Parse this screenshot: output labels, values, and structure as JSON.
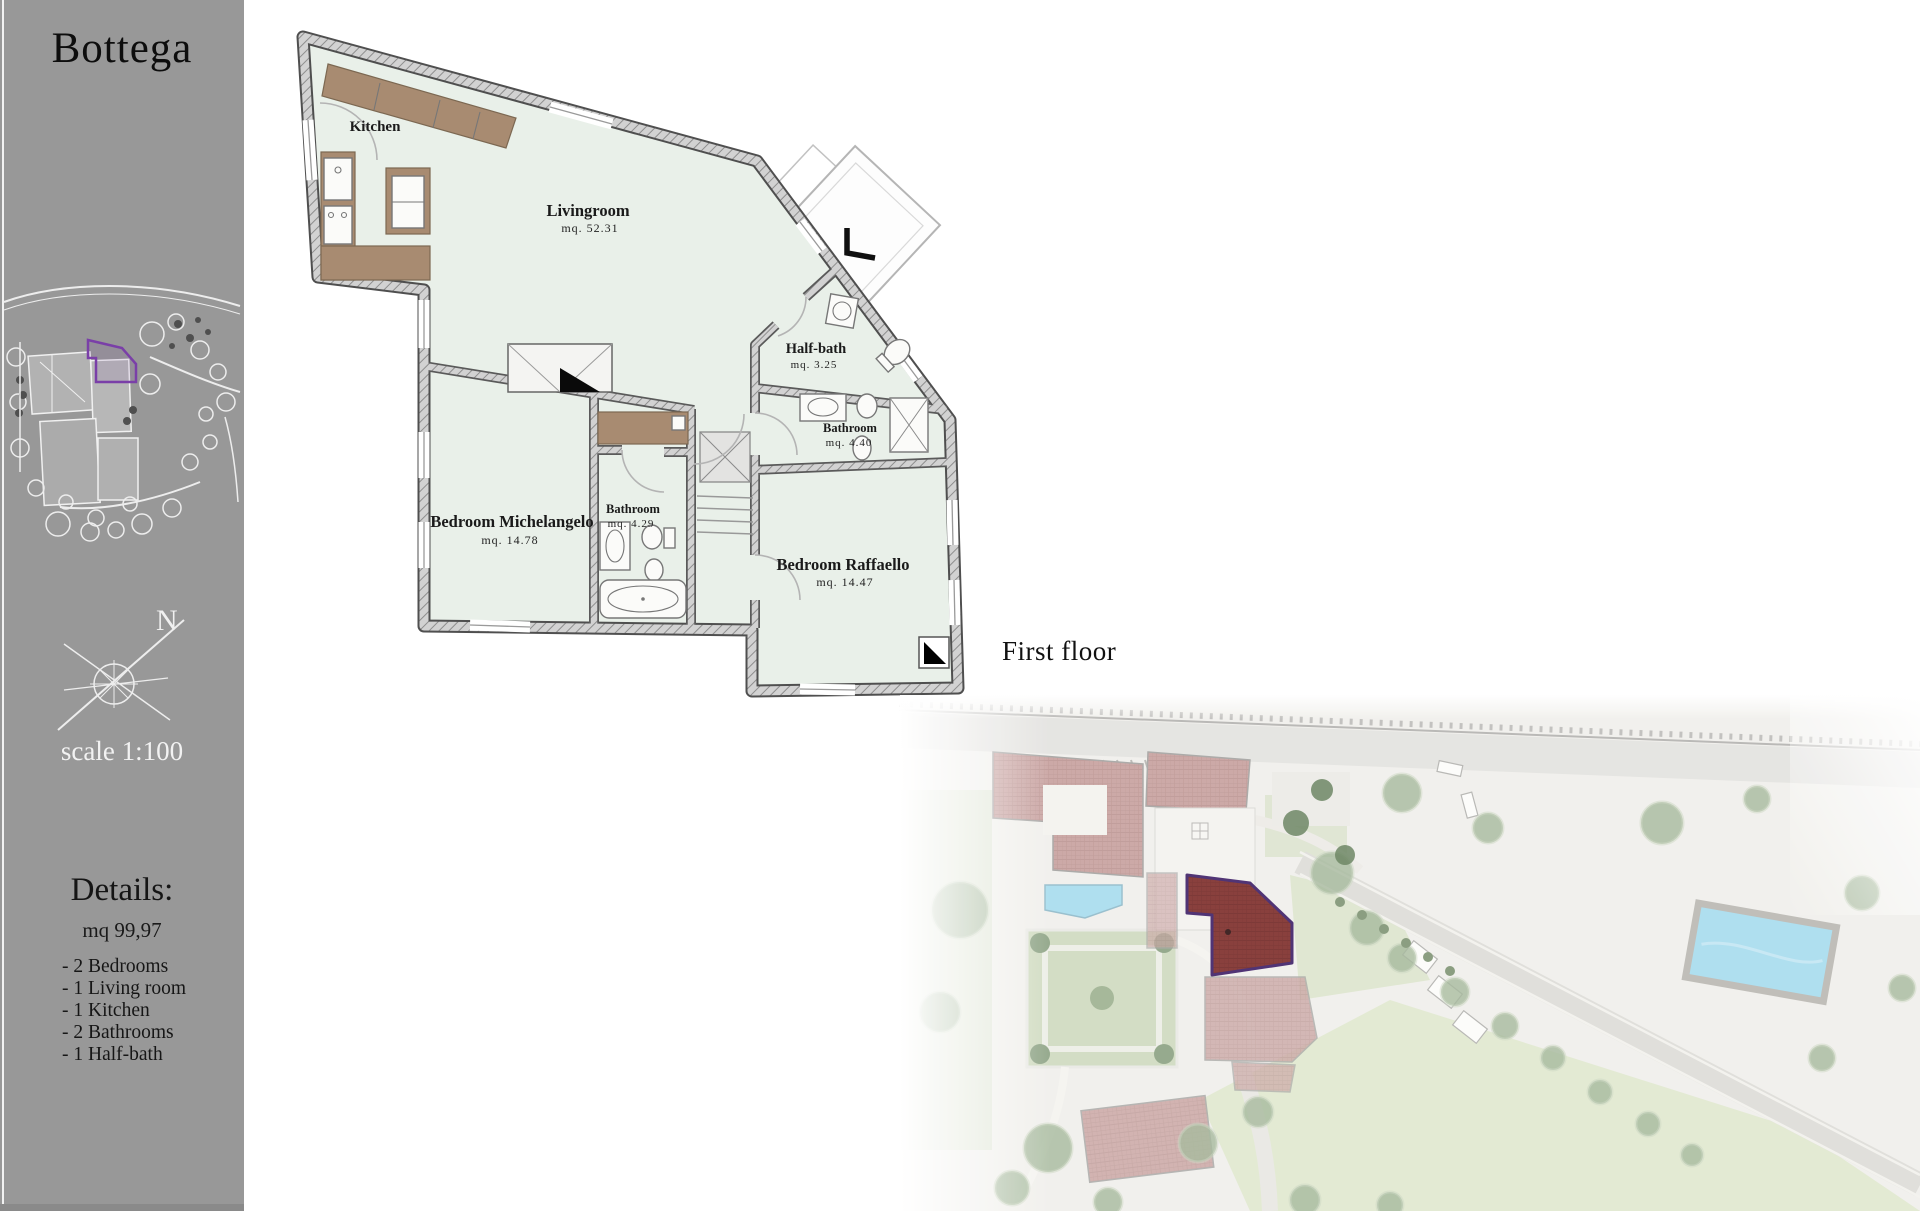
{
  "sidebar": {
    "title": "Bottega",
    "compass_label": "N",
    "scale_label": "scale 1:100",
    "details": {
      "heading": "Details:",
      "area": "mq 99,97",
      "items": [
        "- 2 Bedrooms",
        "- 1 Living room",
        "- 1 Kitchen",
        "- 2 Bathrooms",
        "- 1 Half-bath"
      ]
    }
  },
  "floor_plan": {
    "floor_label": "First floor",
    "rooms": [
      {
        "name": "Kitchen",
        "area": ""
      },
      {
        "name": "Livingroom",
        "area": "mq.  52.31"
      },
      {
        "name": "Half-bath",
        "area": "mq.  3.25"
      },
      {
        "name": "Bathroom",
        "area": "mq.  4.40"
      },
      {
        "name": "Bedroom Michelangelo",
        "area": "mq.  14.78"
      },
      {
        "name": "Bathroom",
        "area": "mq.  4.29"
      },
      {
        "name": "Bedroom Raffaello",
        "area": "mq.  14.47"
      }
    ]
  },
  "site_plan": {
    "highlight_color": "#7d2d2a",
    "highlight_outline": "#3d1d66",
    "pool_color": "#a6dcee",
    "roof_color": "#c7a09e"
  },
  "colors": {
    "sidebar_bg": "#989898",
    "plan_floor": "#e9f0e9",
    "wall_fill": "#d2d2d2",
    "furniture_tan": "#a88b71",
    "thumbnail_outline": "#7a3fa8"
  }
}
